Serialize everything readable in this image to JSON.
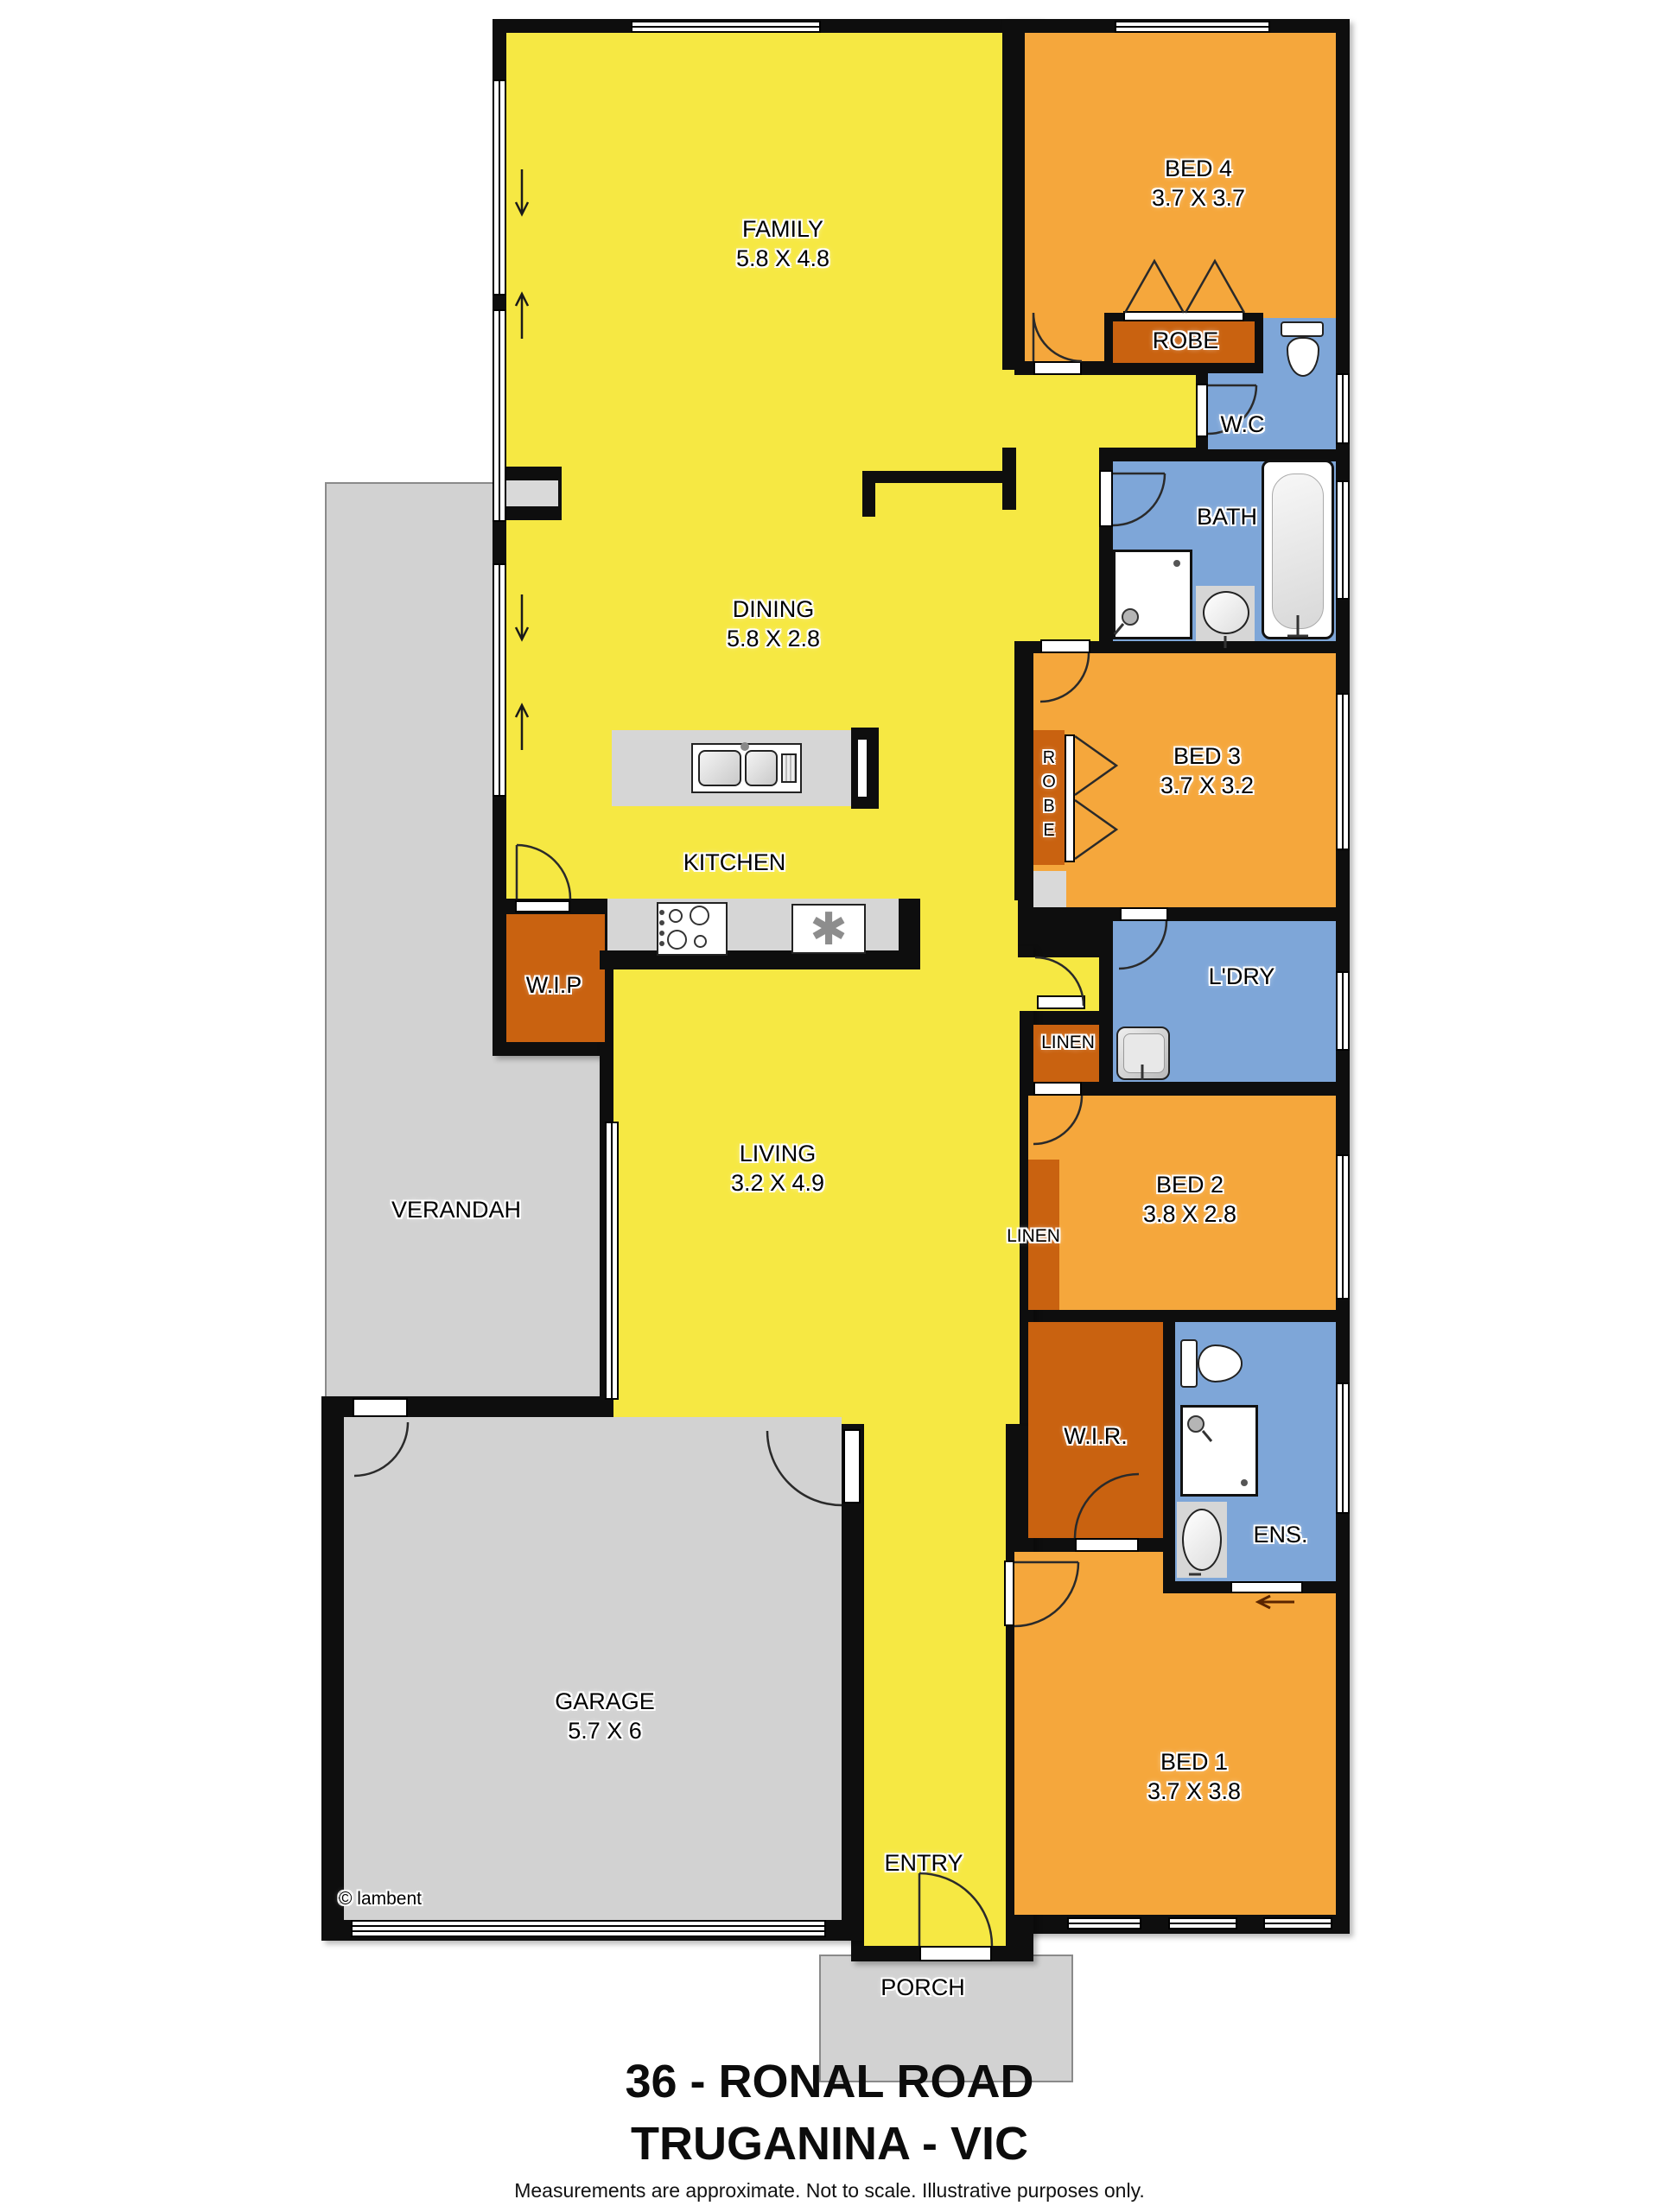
{
  "title": {
    "line1": "36 - RONAL ROAD",
    "line2": "TRUGANINA - VIC",
    "disclaimer": "Measurements are approximate. Not to scale. Illustrative purposes only."
  },
  "watermark": "© lambent",
  "rooms": {
    "family": {
      "name": "FAMILY",
      "dim": "5.8 X 4.8"
    },
    "dining": {
      "name": "DINING",
      "dim": "5.8 X 2.8"
    },
    "kitchen": {
      "name": "KITCHEN"
    },
    "living": {
      "name": "LIVING",
      "dim": "3.2 X 4.9"
    },
    "bed1": {
      "name": "BED 1",
      "dim": "3.7 X 3.8"
    },
    "bed2": {
      "name": "BED 2",
      "dim": "3.8 X 2.8"
    },
    "bed3": {
      "name": "BED 3",
      "dim": "3.7 X 3.2"
    },
    "bed4": {
      "name": "BED 4",
      "dim": "3.7 X 3.7"
    },
    "garage": {
      "name": "GARAGE",
      "dim": "5.7 X 6"
    },
    "verandah": {
      "name": "VERANDAH"
    },
    "porch": {
      "name": "PORCH"
    },
    "entry": {
      "name": "ENTRY"
    },
    "bath": {
      "name": "BATH"
    },
    "wc": {
      "name": "W.C"
    },
    "ens": {
      "name": "ENS."
    },
    "laundry": {
      "name": "L'DRY"
    },
    "wip": {
      "name": "W.I.P"
    },
    "wir": {
      "name": "W.I.R."
    },
    "robe_bed4": {
      "name": "ROBE"
    },
    "robe_bed3": {
      "name": "ROBE"
    },
    "linen_hall": {
      "name": "LINEN"
    },
    "linen_bed2": {
      "name": "LINEN"
    }
  },
  "icons": {
    "appliance_asterisk": "✱"
  },
  "colors": {
    "room_yellow": "#F6E843",
    "room_orange": "#F5A73C",
    "room_dark_orange": "#C96210",
    "room_blue": "#7EA6D8",
    "outdoor_gray": "#D2D2D2",
    "bench_gray": "#D6D6D6",
    "wall_black": "#0E0E0E"
  }
}
